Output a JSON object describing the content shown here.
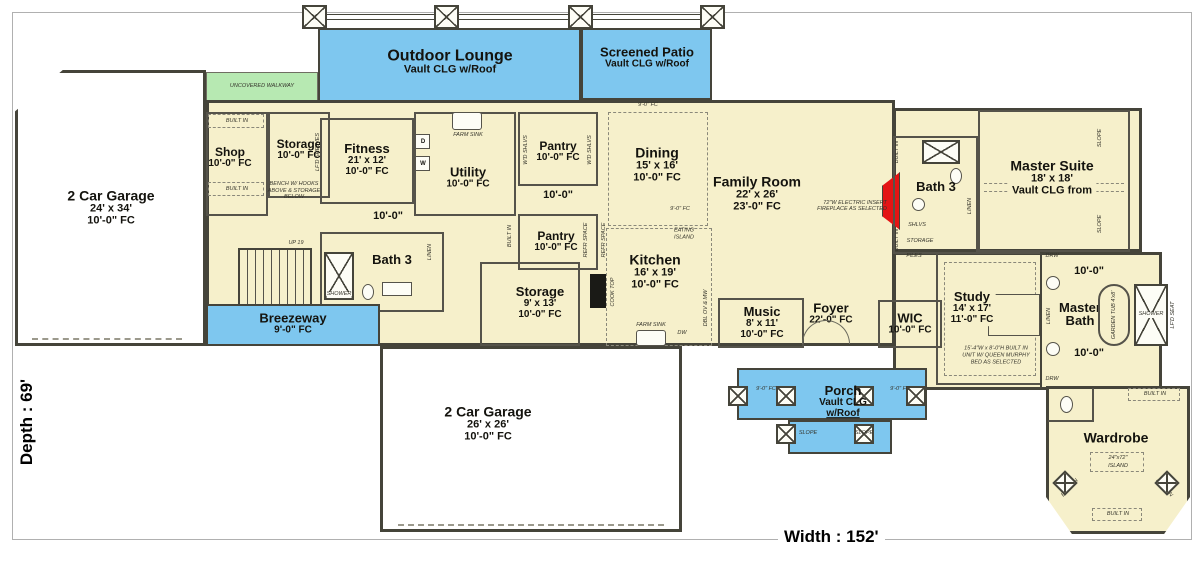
{
  "page": {
    "depth_label": "Depth : 69'",
    "width_label": "Width : 152'"
  },
  "colors": {
    "floor": "#f6f0cb",
    "outdoor_blue": "#7ec7ef",
    "walkway_green": "#b7e9b2",
    "wall": "#45443a",
    "fireplace_red": "#e41414"
  },
  "rooms": {
    "outdoor_lounge": {
      "name": "Outdoor Lounge",
      "l2": "Vault CLG w/Roof"
    },
    "screened_patio": {
      "name": "Screened Patio",
      "l2": "Vault CLG w/Roof"
    },
    "walkway": {
      "name": "UNCOVERED WALKWAY"
    },
    "garage_left": {
      "name": "2 Car Garage",
      "dims": "24' x 34'",
      "ceil": "10'-0\" FC"
    },
    "shop": {
      "name": "Shop",
      "ceil": "10'-0\" FC"
    },
    "storage_top": {
      "name": "Storage",
      "ceil": "10'-0\" FC"
    },
    "fitness": {
      "name": "Fitness",
      "dims": "21' x 12'",
      "ceil": "10'-0\" FC"
    },
    "utility": {
      "name": "Utility",
      "ceil": "10'-0\" FC"
    },
    "pantry_top": {
      "name": "Pantry",
      "ceil": "10'-0\" FC"
    },
    "pantry_bottom": {
      "name": "Pantry",
      "ceil": "10'-0\" FC"
    },
    "dining": {
      "name": "Dining",
      "dims": "15' x 16'",
      "ceil": "10'-0\" FC"
    },
    "family_room": {
      "name": "Family Room",
      "dims": "22' x 26'",
      "ceil": "23'-0\" FC"
    },
    "bath3_right": {
      "name": "Bath 3"
    },
    "master_suite": {
      "name": "Master Suite",
      "dims": "18' x 18'",
      "ceil": "Vault CLG from"
    },
    "kitchen": {
      "name": "Kitchen",
      "dims": "16' x 19'",
      "ceil": "10'-0\" FC"
    },
    "music": {
      "name": "Music",
      "dims": "8' x 11'",
      "ceil": "10'-0\" FC"
    },
    "foyer": {
      "name": "Foyer",
      "ceil": "22'-0\" FC"
    },
    "wic": {
      "name": "WIC",
      "ceil": "10'-0\" FC"
    },
    "study": {
      "name": "Study",
      "dims": "14' x 17'",
      "ceil": "11'-0\" FC"
    },
    "master_bath": {
      "l1": "Master",
      "l2": "Bath"
    },
    "bath3_left": {
      "name": "Bath 3"
    },
    "storage_mid": {
      "name": "Storage",
      "dims": "9' x 13'",
      "ceil": "10'-0\" FC"
    },
    "breezeway": {
      "name": "Breezeway",
      "ceil": "9'-0\" FC"
    },
    "garage_bottom": {
      "name": "2 Car Garage",
      "dims": "26' x 26'",
      "ceil": "10'-0\" FC"
    },
    "porch": {
      "name": "Porch",
      "l2": "Vault CLG",
      "l3": "w/Roof"
    },
    "wardrobe": {
      "name": "Wardrobe"
    }
  },
  "annotations": {
    "built_in": "BUILT IN",
    "bench_l1": "BENCH W/ HOOKS",
    "bench_l2": "ABOVE & STORAGE",
    "bench_l3": "BELOW",
    "lfd_shelves": "LF'D SHELVES",
    "wd_shlvs": "W'D SHLVS",
    "refr_space": "REFR SPACE",
    "farm_sink": "FARM SINK",
    "cook_top": "COOK TOP",
    "dw": "DW",
    "dbl_ov": "DBL OV & MW",
    "eating_l1": "EATING",
    "eating_l2": "ISLAND",
    "fireplace_l1": "72\"W ELECTRIC INSERT",
    "fireplace_l2": "FIREPLACE AS SELECTED",
    "murphy_l1": "15'-4\"W x 8'-0\"H BUILT IN",
    "murphy_l2": "UNIT W/ QUEEN MURPHY",
    "murphy_l3": "BED AS SELECTED",
    "up19": "UP 19",
    "shower": "SHOWER",
    "linen": "LINEN",
    "shlvs": "SHLVS",
    "storage": "STORAGE",
    "files": "FILES",
    "drw": "DRW",
    "garden_tub": "GARDEN TUB 4'x8'",
    "lfd_seat": "LF'D SEAT",
    "island_l1": "24\"x72\"",
    "island_l2": "ISLAND",
    "slope": "SLOPE",
    "fc9": "9'-0\" FC",
    "dim10": "10'-0\"",
    "d": "D",
    "w": "W"
  }
}
